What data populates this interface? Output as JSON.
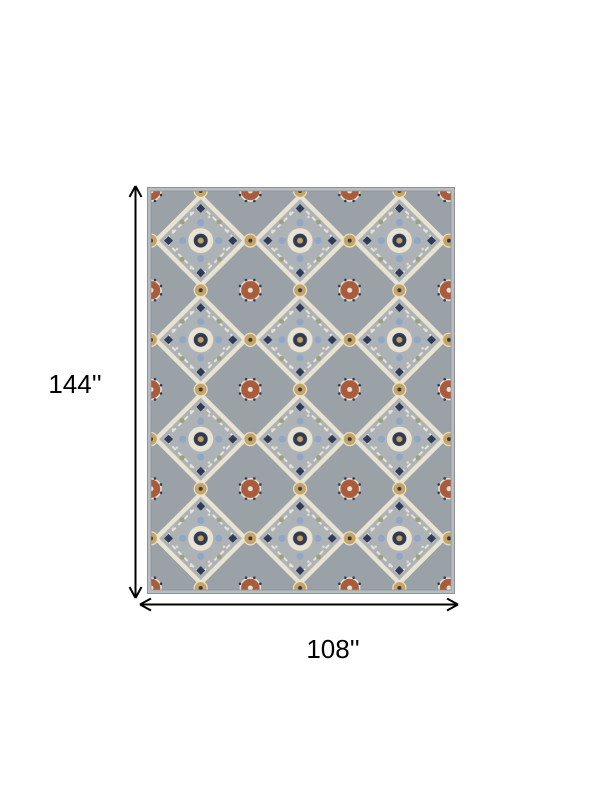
{
  "diagram": {
    "height_label": "144''",
    "width_label": "108''"
  },
  "rug": {
    "style": "ornate-persian-medallion-pattern"
  },
  "colors": {
    "label_text": "#000000",
    "arrow": "#000000",
    "rug_bg": "#9aa1a7",
    "rug_field_light": "#adb2b7",
    "rug_cream": "#e9e3d2",
    "rug_rust": "#a85c3d",
    "rug_navy": "#2e3a56",
    "rug_blue": "#8fa6c4",
    "rug_gold": "#c9a45f",
    "rug_sage": "#9aa37c",
    "rug_selvage": "#b9bdc1",
    "rug_edge": "#8d9298"
  }
}
